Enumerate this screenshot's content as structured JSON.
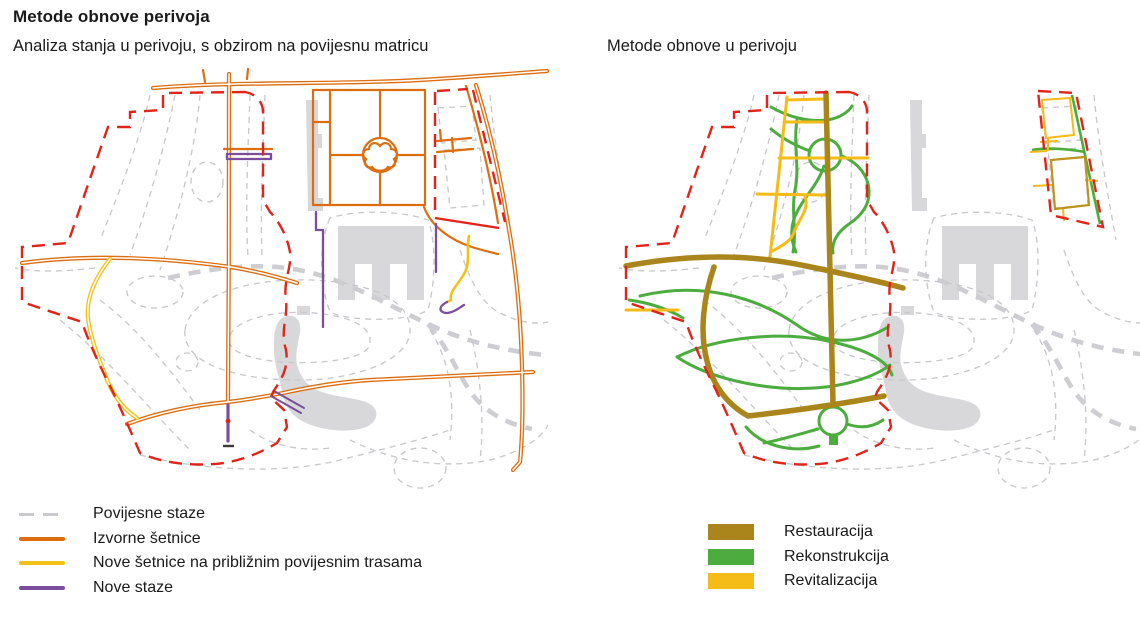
{
  "header": {
    "title": "Metode obnove perivoja"
  },
  "left_panel": {
    "subtitle": "Analiza stanja u perivoju, s obzirom na povijesnu matricu",
    "legend": [
      {
        "label": "Povijesne staze",
        "swatch": "dashed-line",
        "color": "#c9c9ce"
      },
      {
        "label": "Izvorne šetnice",
        "swatch": "line",
        "color": "#dd6e10"
      },
      {
        "label": "Nove šetnice na približnim povijesnim trasama",
        "swatch": "line",
        "color": "#f3c117"
      },
      {
        "label": "Nove staze",
        "swatch": "line",
        "color": "#7b4e9d"
      }
    ]
  },
  "right_panel": {
    "subtitle": "Metode obnove u perivoju",
    "legend": [
      {
        "label": "Restauracija",
        "swatch": "rect",
        "color": "#a9851b"
      },
      {
        "label": "Rekonstrukcija",
        "swatch": "rect",
        "color": "#4cad3e"
      },
      {
        "label": "Revitalizacija",
        "swatch": "rect",
        "color": "#f5bb16"
      }
    ]
  },
  "map_colors": {
    "park_boundary_red": "#e2231a",
    "historic_paths_gray": "#c9c9ce",
    "buildings_gray": "#d8d8da",
    "original_walkways_orange": "#dd6e10",
    "new_walkways_yellow": "#f3c117",
    "new_paths_purple": "#7b4e9d",
    "restoration_olive": "#a9851b",
    "reconstruction_green": "#4cad3e",
    "revitalization_amber": "#f5bb16"
  }
}
